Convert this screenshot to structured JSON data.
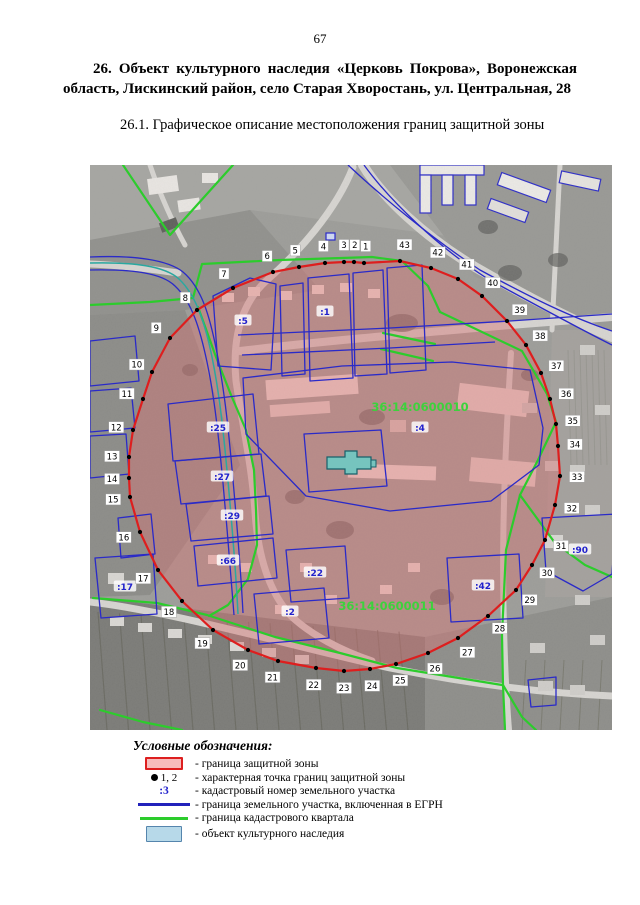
{
  "page": {
    "number": "67"
  },
  "title": "26. Объект культурного наследия «Церковь Покрова», Воронежская область, Лискинский район, село Старая Хворостань, ул. Центральная, 28",
  "subtitle": "26.1. Графическое описание местоположения границ защитной зоны",
  "map": {
    "boundary_points": [
      [
        274,
        98
      ],
      [
        264,
        97
      ],
      [
        254,
        97
      ],
      [
        235,
        98
      ],
      [
        209,
        102
      ],
      [
        183,
        107
      ],
      [
        143,
        123
      ],
      [
        107,
        145
      ],
      [
        80,
        173
      ],
      [
        62,
        207
      ],
      [
        53,
        234
      ],
      [
        43,
        265
      ],
      [
        39,
        292
      ],
      [
        39,
        313
      ],
      [
        40,
        332
      ],
      [
        50,
        367
      ],
      [
        68,
        405
      ],
      [
        92,
        436
      ],
      [
        123,
        465
      ],
      [
        158,
        485
      ],
      [
        188,
        496
      ],
      [
        226,
        503
      ],
      [
        254,
        506
      ],
      [
        280,
        504
      ],
      [
        306,
        499
      ],
      [
        338,
        488
      ],
      [
        368,
        473
      ],
      [
        398,
        451
      ],
      [
        426,
        425
      ],
      [
        442,
        400
      ],
      [
        455,
        375
      ],
      [
        465,
        340
      ],
      [
        470,
        311
      ],
      [
        468,
        281
      ],
      [
        466,
        259
      ],
      [
        460,
        234
      ],
      [
        451,
        208
      ],
      [
        436,
        180
      ],
      [
        417,
        156
      ],
      [
        392,
        131
      ],
      [
        368,
        114
      ],
      [
        341,
        103
      ],
      [
        310,
        96
      ]
    ],
    "quarter_labels": [
      {
        "text": "36:14:0600010",
        "x": 330,
        "y": 246
      },
      {
        "text": "36:14:0600011",
        "x": 297,
        "y": 445
      }
    ],
    "parcel_labels": [
      {
        "text": ":5",
        "x": 153,
        "y": 156
      },
      {
        "text": ":1",
        "x": 235,
        "y": 147
      },
      {
        "text": ":25",
        "x": 128,
        "y": 263
      },
      {
        "text": ":27",
        "x": 132,
        "y": 312
      },
      {
        "text": ":29",
        "x": 142,
        "y": 351
      },
      {
        "text": ":66",
        "x": 138,
        "y": 396
      },
      {
        "text": ":17",
        "x": 35,
        "y": 422
      },
      {
        "text": ":22",
        "x": 225,
        "y": 408
      },
      {
        "text": ":2",
        "x": 200,
        "y": 447
      },
      {
        "text": ":42",
        "x": 393,
        "y": 421
      },
      {
        "text": ":90",
        "x": 490,
        "y": 385
      },
      {
        "text": ":4",
        "x": 330,
        "y": 263
      }
    ],
    "colors": {
      "zone_fill": "rgba(214,118,118,0.45)",
      "zone_stroke": "#de1e1e",
      "parcel_line": "#2a2ac8",
      "quarter_line": "#2ccc2c",
      "egrn_teal": "#2aa8a0",
      "heritage_fill": "#76c4be",
      "heritage_stroke": "#17606a",
      "point_fill": "#000000",
      "quarter_label": "#3cd23c",
      "parcel_label": "#2222cc"
    }
  },
  "legend": {
    "title": "Условные обозначения:",
    "items": [
      {
        "symbol": "zone-swatch",
        "label": "- граница защитной зоны"
      },
      {
        "symbol": "boundary-point",
        "symbol_text": "1, 2",
        "label": "- характерная точка границ защитной зоны"
      },
      {
        "symbol": "cadastral-number",
        "symbol_text": ":3",
        "label": "- кадастровый номер земельного участка"
      },
      {
        "symbol": "parcel-line",
        "label": "- граница земельного участка, включенная в ЕГРН"
      },
      {
        "symbol": "quarter-line",
        "label": "- граница кадастрового квартала"
      },
      {
        "symbol": "heritage-swatch",
        "label": "- объект культурного наследия"
      }
    ]
  }
}
